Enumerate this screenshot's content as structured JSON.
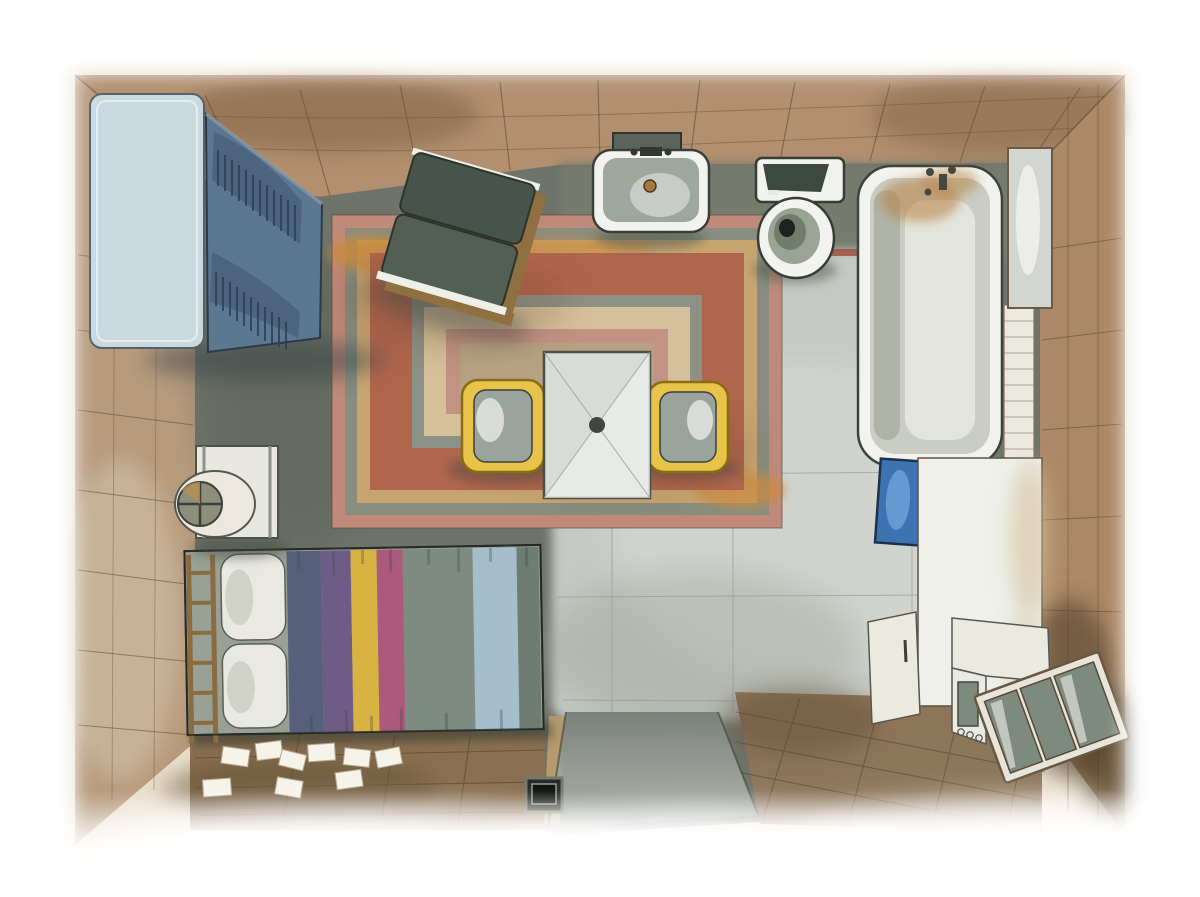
{
  "scene": {
    "medium": "watercolor and ink illustration",
    "subject": "top-down perspective view of a studio apartment interior",
    "orientation": "landscape",
    "canvas": {
      "width": 1200,
      "height": 897
    }
  },
  "palette": {
    "paper": "#ffffff",
    "wash_edge": "#e7dac5",
    "wall_wood": "#b28f6f",
    "wall_wood_dark": "#7d5f43",
    "wall_left": "#b79b7d",
    "wall_right": "#ab8866",
    "floor_dark": "#6e746a",
    "floor_bath": "#767c6e",
    "floor_tile": "#c5c9c3",
    "floor_wood": "#8a7052",
    "floor_wood_right": "#8d755a",
    "accent_red": "#9b5440",
    "entry_gray": "#8a9089",
    "rug_pink": "#c08a7a",
    "rug_green": "#878d7f",
    "rug_tan": "#c7a571",
    "rug_orange": "#cc8a3e",
    "rug_terracotta": "#b0664d",
    "rug_gray": "#8e9187",
    "rug_cream": "#d6c09a",
    "rug_inner_pink": "#c29384",
    "rug_center": "#b7a183",
    "wardrobe_top": "#c9dade",
    "wardrobe_front": "#5c7890",
    "wardrobe_slat": "#2e4258",
    "chair_cushion": "#47544b",
    "chair_cushion2": "#535f52",
    "chair_wood": "#8f7040",
    "white_fixture": "#f2f3ee",
    "sink_basin": "#9da79d",
    "drain_brass": "#a8793a",
    "toilet_tank": "#3c4a3e",
    "tub_inner": "#c9cdc4",
    "tub_stain": "#b8803f",
    "tile_strip": "#ece9e0",
    "mirror_panel": "#d2d5d0",
    "mat_blue": "#3e73b2",
    "partition_white": "#eef0e9",
    "cabinet_white": "#eceadf",
    "glass_cabinet_body": "#e7e5da",
    "glass_pane": "#7e8a7d",
    "table_top": "#d8dbd6",
    "chair_yellow": "#e8c34a",
    "chair_seat": "#9aa39c",
    "pillow": "#e9e9e1",
    "headboard_brass": "#8a6c40",
    "nightstand": "#e8e7e0",
    "lamp_face": "#8e8f7a",
    "paper_sheet": "#f5f3ea",
    "box_dark": "#262b27"
  },
  "bed": {
    "stripes": [
      "#56607a",
      "#6f5c86",
      "#d8b342",
      "#ab5a7c",
      "#7e8b80",
      "#a4becb",
      "#6d7d72"
    ]
  },
  "objects": [
    {
      "id": "wardrobe",
      "label": "blue wardrobe with louvered doors",
      "area": "top-left"
    },
    {
      "id": "armchair",
      "label": "dark green upholstered armchair with wood frame",
      "area": "top-center-left"
    },
    {
      "id": "wash-basin",
      "label": "wall sink with brass drain and shelf",
      "area": "top-center"
    },
    {
      "id": "toilet",
      "label": "toilet with cistern",
      "area": "top-center-right"
    },
    {
      "id": "bathtub",
      "label": "bathtub with taps and rust stains",
      "area": "top-right"
    },
    {
      "id": "mirror-panel",
      "label": "gray wall panel beside tub",
      "area": "right-wall"
    },
    {
      "id": "tile-strip",
      "label": "white tiled strip beside bathtub",
      "area": "right"
    },
    {
      "id": "blue-mat",
      "label": "blue bath mat",
      "area": "right-middle"
    },
    {
      "id": "partition",
      "label": "white partition counter",
      "area": "right-middle"
    },
    {
      "id": "kitchen-counter",
      "label": "small white cabinet",
      "area": "bottom-right"
    },
    {
      "id": "stove",
      "label": "stove with glass door and three knobs",
      "area": "bottom-right"
    },
    {
      "id": "glass-cabinet",
      "label": "wood-framed glass-front cabinet",
      "area": "bottom-right-corner"
    },
    {
      "id": "area-rug",
      "label": "layered rug with concentric pink, tan, terracotta and gray bands",
      "area": "center"
    },
    {
      "id": "dining-table",
      "label": "square white pedestal table",
      "area": "center"
    },
    {
      "id": "dining-chairs",
      "label": "two yellow-framed chairs with gray seats",
      "area": "center"
    },
    {
      "id": "bed",
      "label": "double bed with vertical striped blanket",
      "area": "bottom-left"
    },
    {
      "id": "pillows",
      "label": "two white pillows",
      "area": "bottom-left"
    },
    {
      "id": "headboard",
      "label": "brass ladder headboard",
      "area": "left"
    },
    {
      "id": "nightstand",
      "label": "bedside table with round fan lamp",
      "area": "left-middle"
    },
    {
      "id": "papers",
      "label": "white paper sheets scattered on wood floor",
      "area": "bottom-left"
    },
    {
      "id": "entry-runner",
      "label": "gray entry runner at doorway",
      "area": "bottom-center"
    },
    {
      "id": "floor-box",
      "label": "small dark crate beside door",
      "area": "bottom-center"
    }
  ]
}
